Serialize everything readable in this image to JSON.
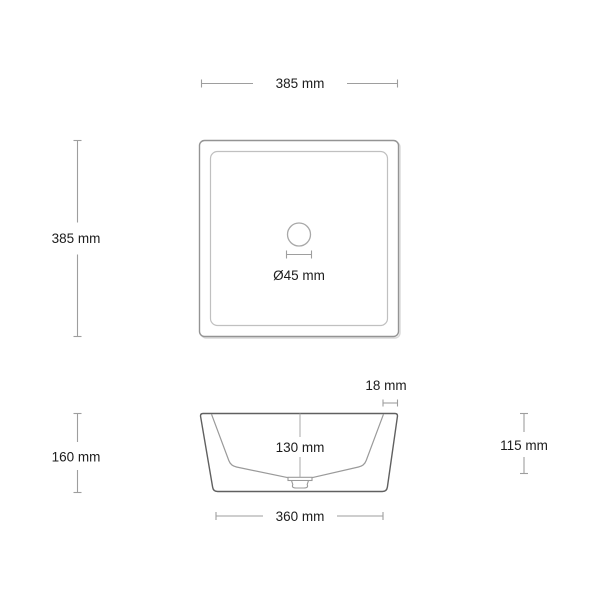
{
  "drawing": {
    "kind": "technical-dimension-drawing",
    "subject": "square-countertop-basin",
    "colors": {
      "background": "#ffffff",
      "dimension_line": "#9e9e9e",
      "plan_outer_edge": "#949494",
      "plan_inner_rim": "#c0c0c0",
      "plan_shadow": "#d9d9d9",
      "drain_circle": "#a8a8a8",
      "side_outline": "#606060",
      "side_inner_wall": "#9a9a9a",
      "text": "#1c1c1c"
    },
    "top_view": {
      "width": {
        "value": 385,
        "unit": "mm",
        "label": "385 mm"
      },
      "depth": {
        "value": 385,
        "unit": "mm",
        "label": "385 mm"
      },
      "drain_diameter": {
        "value": 45,
        "unit": "mm",
        "label": "Ø45 mm"
      }
    },
    "side_view": {
      "rim_thickness": {
        "value": 18,
        "unit": "mm",
        "label": "18 mm"
      },
      "total_height": {
        "value": 160,
        "unit": "mm",
        "label": "160 mm"
      },
      "inner_depth": {
        "value": 130,
        "unit": "mm",
        "label": "130 mm"
      },
      "base_width": {
        "value": 360,
        "unit": "mm",
        "label": "360 mm"
      },
      "side_height": {
        "value": 115,
        "unit": "mm",
        "label": "115 mm"
      }
    }
  }
}
